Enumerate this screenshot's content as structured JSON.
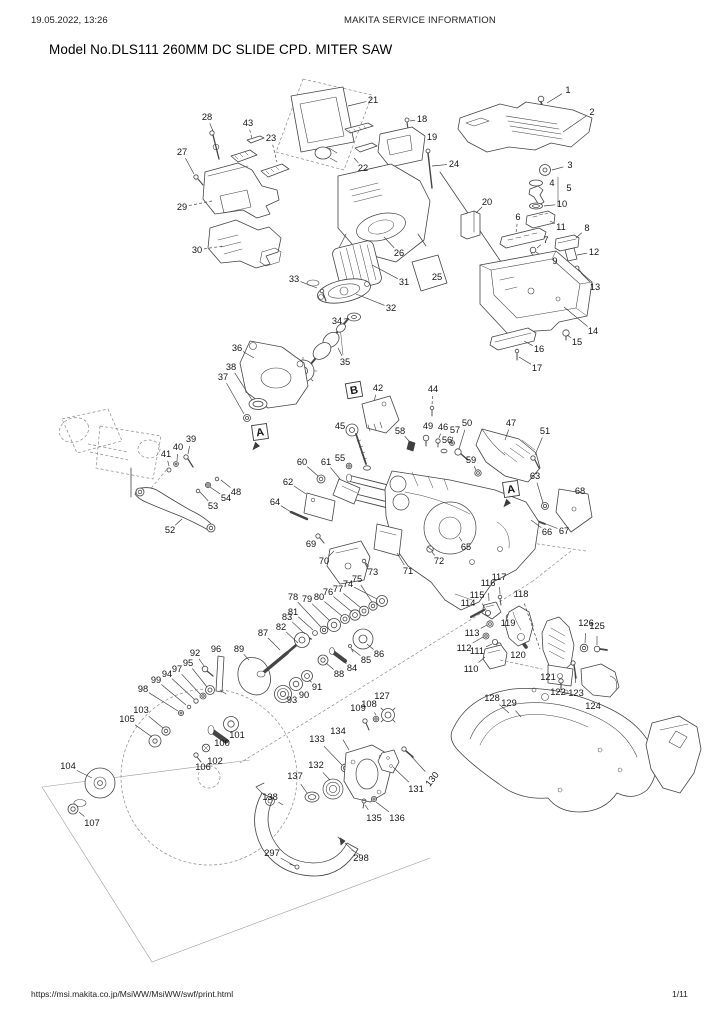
{
  "header": {
    "datetime": "19.05.2022, 13:26",
    "center": "MAKITA SERVICE INFORMATION"
  },
  "title": "Model No.DLS111 260MM DC SLIDE CPD. MITER SAW",
  "footer": {
    "url": "https://msi.makita.co.jp/MsiWW/MsiWW/swf/print.html",
    "page": "1/11"
  },
  "diagram": {
    "ink": "#3c3c3c",
    "callout_font_px": 9.3,
    "section_markers": [
      {
        "label": "A",
        "x": 260,
        "y": 432,
        "rot": -8,
        "arrow": 1
      },
      {
        "label": "A",
        "x": 511,
        "y": 489,
        "rot": -8,
        "arrow": 1
      },
      {
        "label": "B",
        "x": 354,
        "y": 390,
        "rot": -10,
        "arrow": 0
      }
    ],
    "callouts": [
      {
        "n": "1",
        "x": 568,
        "y": 90,
        "tx": 547,
        "ty": 103
      },
      {
        "n": "2",
        "x": 592,
        "y": 112,
        "tx": 563,
        "ty": 132
      },
      {
        "n": "3",
        "x": 570,
        "y": 165,
        "tx": 552,
        "ty": 170
      },
      {
        "n": "4",
        "x": 552,
        "y": 183,
        "tx": 544,
        "ty": 183
      },
      {
        "n": "5",
        "x": 569,
        "y": 188,
        "tx": 560,
        "ty": 190
      },
      {
        "n": "6",
        "x": 518,
        "y": 217,
        "tx": 516,
        "ty": 233,
        "d": 1
      },
      {
        "n": "7",
        "x": 546,
        "y": 240,
        "tx": 537,
        "ty": 248
      },
      {
        "n": "8",
        "x": 587,
        "y": 228,
        "tx": 576,
        "ty": 238
      },
      {
        "n": "9",
        "x": 555,
        "y": 261,
        "tx": 546,
        "ty": 260
      },
      {
        "n": "10",
        "x": 562,
        "y": 204,
        "tx": 544,
        "ty": 206
      },
      {
        "n": "11",
        "x": 561,
        "y": 227,
        "tx": 550,
        "ty": 221
      },
      {
        "n": "12",
        "x": 594,
        "y": 252,
        "tx": 577,
        "ty": 255
      },
      {
        "n": "13",
        "x": 595,
        "y": 287,
        "tx": 581,
        "ty": 273
      },
      {
        "n": "14",
        "x": 593,
        "y": 331,
        "tx": 564,
        "ty": 307
      },
      {
        "n": "15",
        "x": 577,
        "y": 342,
        "tx": 567,
        "ty": 335
      },
      {
        "n": "16",
        "x": 539,
        "y": 349,
        "tx": 524,
        "ty": 341
      },
      {
        "n": "17",
        "x": 537,
        "y": 368,
        "tx": 519,
        "ty": 357
      },
      {
        "n": "18",
        "x": 422,
        "y": 119,
        "tx": 410,
        "ty": 121
      },
      {
        "n": "19",
        "x": 432,
        "y": 137,
        "tx": 424,
        "ty": 141
      },
      {
        "n": "20",
        "x": 487,
        "y": 202,
        "tx": 476,
        "ty": 213
      },
      {
        "n": "21",
        "x": 373,
        "y": 100,
        "tx": 348,
        "ty": 106
      },
      {
        "n": "22",
        "x": 363,
        "y": 168,
        "tx": 354,
        "ty": 158
      },
      {
        "n": "23",
        "x": 271,
        "y": 138,
        "tx": 277,
        "ty": 162,
        "d": 1
      },
      {
        "n": "24",
        "x": 454,
        "y": 164,
        "tx": 432,
        "ty": 166
      },
      {
        "n": "25",
        "x": 437,
        "y": 277,
        "tx": 432,
        "ty": 272
      },
      {
        "n": "26",
        "x": 399,
        "y": 253,
        "tx": 384,
        "ty": 237
      },
      {
        "n": "27",
        "x": 182,
        "y": 152,
        "tx": 194,
        "ty": 174
      },
      {
        "n": "28",
        "x": 207,
        "y": 117,
        "tx": 213,
        "ty": 131
      },
      {
        "n": "29",
        "x": 182,
        "y": 207,
        "tx": 212,
        "ty": 201,
        "d": 1
      },
      {
        "n": "30",
        "x": 197,
        "y": 250,
        "tx": 223,
        "ty": 246,
        "d": 1
      },
      {
        "n": "31",
        "x": 404,
        "y": 282,
        "tx": 372,
        "ty": 265
      },
      {
        "n": "32",
        "x": 391,
        "y": 308,
        "tx": 356,
        "ty": 294
      },
      {
        "n": "33",
        "x": 294,
        "y": 279,
        "tx": 317,
        "ty": 288
      },
      {
        "n": "34",
        "x": 337,
        "y": 321,
        "tx": 348,
        "ty": 318
      },
      {
        "n": "35",
        "x": 345,
        "y": 362,
        "tx": 338,
        "ty": 348
      },
      {
        "n": "36",
        "x": 237,
        "y": 348,
        "tx": 254,
        "ty": 358
      },
      {
        "n": "37",
        "x": 223,
        "y": 377,
        "tx": 244,
        "ty": 414
      },
      {
        "n": "38",
        "x": 231,
        "y": 367,
        "tx": 252,
        "ty": 400
      },
      {
        "n": "39",
        "x": 191,
        "y": 439,
        "tx": 188,
        "ty": 454
      },
      {
        "n": "40",
        "x": 178,
        "y": 447,
        "tx": 177,
        "ty": 461
      },
      {
        "n": "41",
        "x": 166,
        "y": 454,
        "tx": 169,
        "ty": 466
      },
      {
        "n": "42",
        "x": 378,
        "y": 388,
        "tx": 374,
        "ty": 401
      },
      {
        "n": "43",
        "x": 248,
        "y": 123,
        "tx": 252,
        "ty": 139,
        "d": 1
      },
      {
        "n": "44",
        "x": 433,
        "y": 389,
        "tx": 432,
        "ty": 405,
        "d": 1
      },
      {
        "n": "45",
        "x": 340,
        "y": 426,
        "tx": 347,
        "ty": 429
      },
      {
        "n": "46",
        "x": 443,
        "y": 427,
        "tx": 439,
        "ty": 438
      },
      {
        "n": "47",
        "x": 511,
        "y": 423,
        "tx": 505,
        "ty": 440
      },
      {
        "n": "48",
        "x": 236,
        "y": 492,
        "tx": 221,
        "ty": 480
      },
      {
        "n": "49",
        "x": 428,
        "y": 426,
        "tx": 426,
        "ty": 435
      },
      {
        "n": "50",
        "x": 467,
        "y": 423,
        "tx": 459,
        "ty": 449
      },
      {
        "n": "51",
        "x": 545,
        "y": 431,
        "tx": 535,
        "ty": 455
      },
      {
        "n": "52",
        "x": 170,
        "y": 530,
        "tx": 182,
        "ty": 519
      },
      {
        "n": "53",
        "x": 213,
        "y": 506,
        "tx": 200,
        "ty": 492
      },
      {
        "n": "54",
        "x": 226,
        "y": 498,
        "tx": 210,
        "ty": 487
      },
      {
        "n": "55",
        "x": 340,
        "y": 458,
        "tx": 347,
        "ty": 464
      },
      {
        "n": "56",
        "x": 447,
        "y": 440,
        "tx": 445,
        "ty": 448
      },
      {
        "n": "57",
        "x": 455,
        "y": 430,
        "tx": 452,
        "ty": 440
      },
      {
        "n": "58",
        "x": 400,
        "y": 431,
        "tx": 409,
        "ty": 441
      },
      {
        "n": "59",
        "x": 471,
        "y": 460,
        "tx": 476,
        "ty": 470
      },
      {
        "n": "60",
        "x": 302,
        "y": 462,
        "tx": 318,
        "ty": 476
      },
      {
        "n": "61",
        "x": 326,
        "y": 462,
        "tx": 340,
        "ty": 479
      },
      {
        "n": "62",
        "x": 288,
        "y": 482,
        "tx": 306,
        "ty": 494
      },
      {
        "n": "63",
        "x": 535,
        "y": 476,
        "tx": 543,
        "ty": 503
      },
      {
        "n": "64",
        "x": 275,
        "y": 502,
        "tx": 291,
        "ty": 512
      },
      {
        "n": "65",
        "x": 466,
        "y": 547,
        "tx": 459,
        "ty": 537
      },
      {
        "n": "66",
        "x": 547,
        "y": 532,
        "tx": 531,
        "ty": 520
      },
      {
        "n": "67",
        "x": 564,
        "y": 531,
        "tx": 546,
        "ty": 524
      },
      {
        "n": "68",
        "x": 580,
        "y": 491,
        "tx": 573,
        "ty": 497
      },
      {
        "n": "69",
        "x": 311,
        "y": 544,
        "tx": 316,
        "ty": 537
      },
      {
        "n": "70",
        "x": 324,
        "y": 561,
        "tx": 334,
        "ty": 551
      },
      {
        "n": "71",
        "x": 408,
        "y": 571,
        "tx": 397,
        "ty": 553
      },
      {
        "n": "72",
        "x": 439,
        "y": 561,
        "tx": 432,
        "ty": 552
      },
      {
        "n": "73",
        "x": 373,
        "y": 572,
        "tx": 366,
        "ty": 563
      },
      {
        "n": "74",
        "x": 348,
        "y": 584,
        "tx": 377,
        "ty": 599
      },
      {
        "n": "75",
        "x": 357,
        "y": 579,
        "tx": 372,
        "ty": 602
      },
      {
        "n": "76",
        "x": 328,
        "y": 592,
        "tx": 352,
        "ty": 612
      },
      {
        "n": "77",
        "x": 338,
        "y": 589,
        "tx": 361,
        "ty": 608
      },
      {
        "n": "78",
        "x": 293,
        "y": 597,
        "tx": 321,
        "ty": 627
      },
      {
        "n": "79",
        "x": 307,
        "y": 599,
        "tx": 330,
        "ty": 621
      },
      {
        "n": "80",
        "x": 319,
        "y": 597,
        "tx": 342,
        "ty": 616
      },
      {
        "n": "81",
        "x": 293,
        "y": 612,
        "tx": 313,
        "ty": 630
      },
      {
        "n": "82",
        "x": 281,
        "y": 627,
        "tx": 298,
        "ty": 643
      },
      {
        "n": "83",
        "x": 287,
        "y": 617,
        "tx": 305,
        "ty": 634
      },
      {
        "n": "84",
        "x": 352,
        "y": 668,
        "tx": 340,
        "ty": 659
      },
      {
        "n": "85",
        "x": 366,
        "y": 660,
        "tx": 352,
        "ty": 649
      },
      {
        "n": "86",
        "x": 379,
        "y": 654,
        "tx": 367,
        "ty": 644
      },
      {
        "n": "87",
        "x": 263,
        "y": 633,
        "tx": 280,
        "ty": 650
      },
      {
        "n": "88",
        "x": 339,
        "y": 674,
        "tx": 326,
        "ty": 663
      },
      {
        "n": "89",
        "x": 239,
        "y": 649,
        "tx": 249,
        "ty": 660
      },
      {
        "n": "90",
        "x": 304,
        "y": 695,
        "tx": 298,
        "ty": 688
      },
      {
        "n": "91",
        "x": 317,
        "y": 687,
        "tx": 309,
        "ty": 680
      },
      {
        "n": "92",
        "x": 195,
        "y": 653,
        "tx": 204,
        "ty": 666
      },
      {
        "n": "93",
        "x": 292,
        "y": 700,
        "tx": 286,
        "ty": 696
      },
      {
        "n": "94",
        "x": 167,
        "y": 674,
        "tx": 194,
        "ty": 699
      },
      {
        "n": "95",
        "x": 188,
        "y": 663,
        "tx": 207,
        "ty": 687
      },
      {
        "n": "96",
        "x": 216,
        "y": 649,
        "tx": 220,
        "ty": 657
      },
      {
        "n": "97",
        "x": 177,
        "y": 669,
        "tx": 200,
        "ty": 694
      },
      {
        "n": "98",
        "x": 143,
        "y": 689,
        "tx": 178,
        "ty": 711
      },
      {
        "n": "99",
        "x": 156,
        "y": 680,
        "tx": 186,
        "ty": 705
      },
      {
        "n": "100",
        "x": 222,
        "y": 743,
        "tx": 215,
        "ty": 735
      },
      {
        "n": "101",
        "x": 237,
        "y": 735,
        "tx": 231,
        "ty": 728
      },
      {
        "n": "102",
        "x": 215,
        "y": 761,
        "tx": 207,
        "ty": 751
      },
      {
        "n": "103",
        "x": 141,
        "y": 710,
        "tx": 163,
        "ty": 728
      },
      {
        "n": "104",
        "x": 68,
        "y": 766,
        "tx": 92,
        "ty": 778
      },
      {
        "n": "105",
        "x": 127,
        "y": 719,
        "tx": 152,
        "ty": 737
      },
      {
        "n": "106",
        "x": 203,
        "y": 767,
        "tx": 196,
        "ty": 757
      },
      {
        "n": "107",
        "x": 92,
        "y": 823,
        "tx": 79,
        "ty": 812
      },
      {
        "n": "108",
        "x": 369,
        "y": 704,
        "tx": 376,
        "ty": 715
      },
      {
        "n": "109",
        "x": 358,
        "y": 708,
        "tx": 364,
        "ty": 718
      },
      {
        "n": "110",
        "x": 471,
        "y": 669,
        "tx": 485,
        "ty": 657
      },
      {
        "n": "111",
        "x": 477,
        "y": 651,
        "tx": 492,
        "ty": 644
      },
      {
        "n": "112",
        "x": 464,
        "y": 648,
        "tx": 483,
        "ty": 637
      },
      {
        "n": "113",
        "x": 472,
        "y": 633,
        "tx": 487,
        "ty": 625
      },
      {
        "n": "114",
        "x": 468,
        "y": 603,
        "tx": 475,
        "ty": 613
      },
      {
        "n": "115",
        "x": 477,
        "y": 595,
        "tx": 486,
        "ty": 610
      },
      {
        "n": "116",
        "x": 488,
        "y": 583,
        "tx": 489,
        "ty": 601
      },
      {
        "n": "117",
        "x": 499,
        "y": 577,
        "tx": 500,
        "ty": 594
      },
      {
        "n": "118",
        "x": 521,
        "y": 594,
        "tx": 540,
        "ty": 649,
        "d": 1
      },
      {
        "n": "119",
        "x": 508,
        "y": 623,
        "tx": 509,
        "ty": 630
      },
      {
        "n": "120",
        "x": 518,
        "y": 655,
        "tx": 521,
        "ty": 644
      },
      {
        "n": "121",
        "x": 548,
        "y": 677,
        "tx": 553,
        "ty": 670
      },
      {
        "n": "122",
        "x": 558,
        "y": 692,
        "tx": 561,
        "ty": 684
      },
      {
        "n": "123",
        "x": 576,
        "y": 693,
        "tx": 575,
        "ty": 674
      },
      {
        "n": "124",
        "x": 593,
        "y": 706,
        "tx": 594,
        "ty": 695
      },
      {
        "n": "125",
        "x": 597,
        "y": 626,
        "tx": 597,
        "ty": 645
      },
      {
        "n": "126",
        "x": 586,
        "y": 623,
        "tx": 585,
        "ty": 643
      },
      {
        "n": "127",
        "x": 382,
        "y": 696,
        "tx": 387,
        "ty": 708
      },
      {
        "n": "128",
        "x": 492,
        "y": 698,
        "tx": 509,
        "ty": 713
      },
      {
        "n": "129",
        "x": 509,
        "y": 703,
        "tx": 521,
        "ty": 717
      },
      {
        "n": "130",
        "x": 432,
        "y": 779,
        "tx": 411,
        "ty": 756,
        "rot": -52
      },
      {
        "n": "131",
        "x": 416,
        "y": 789,
        "tx": 393,
        "ty": 767
      },
      {
        "n": "132",
        "x": 316,
        "y": 765,
        "tx": 330,
        "ty": 780
      },
      {
        "n": "133",
        "x": 317,
        "y": 739,
        "tx": 342,
        "ty": 765
      },
      {
        "n": "134",
        "x": 338,
        "y": 731,
        "tx": 349,
        "ty": 750
      },
      {
        "n": "135",
        "x": 374,
        "y": 818,
        "tx": 365,
        "ty": 805
      },
      {
        "n": "136",
        "x": 397,
        "y": 818,
        "tx": 376,
        "ty": 802
      },
      {
        "n": "137",
        "x": 295,
        "y": 776,
        "tx": 307,
        "ty": 793
      },
      {
        "n": "138",
        "x": 270,
        "y": 797,
        "tx": 283,
        "ty": 805
      },
      {
        "n": "297",
        "x": 272,
        "y": 853,
        "tx": 293,
        "ty": 865
      },
      {
        "n": "298",
        "x": 361,
        "y": 858,
        "tx": 345,
        "ty": 843
      }
    ]
  }
}
